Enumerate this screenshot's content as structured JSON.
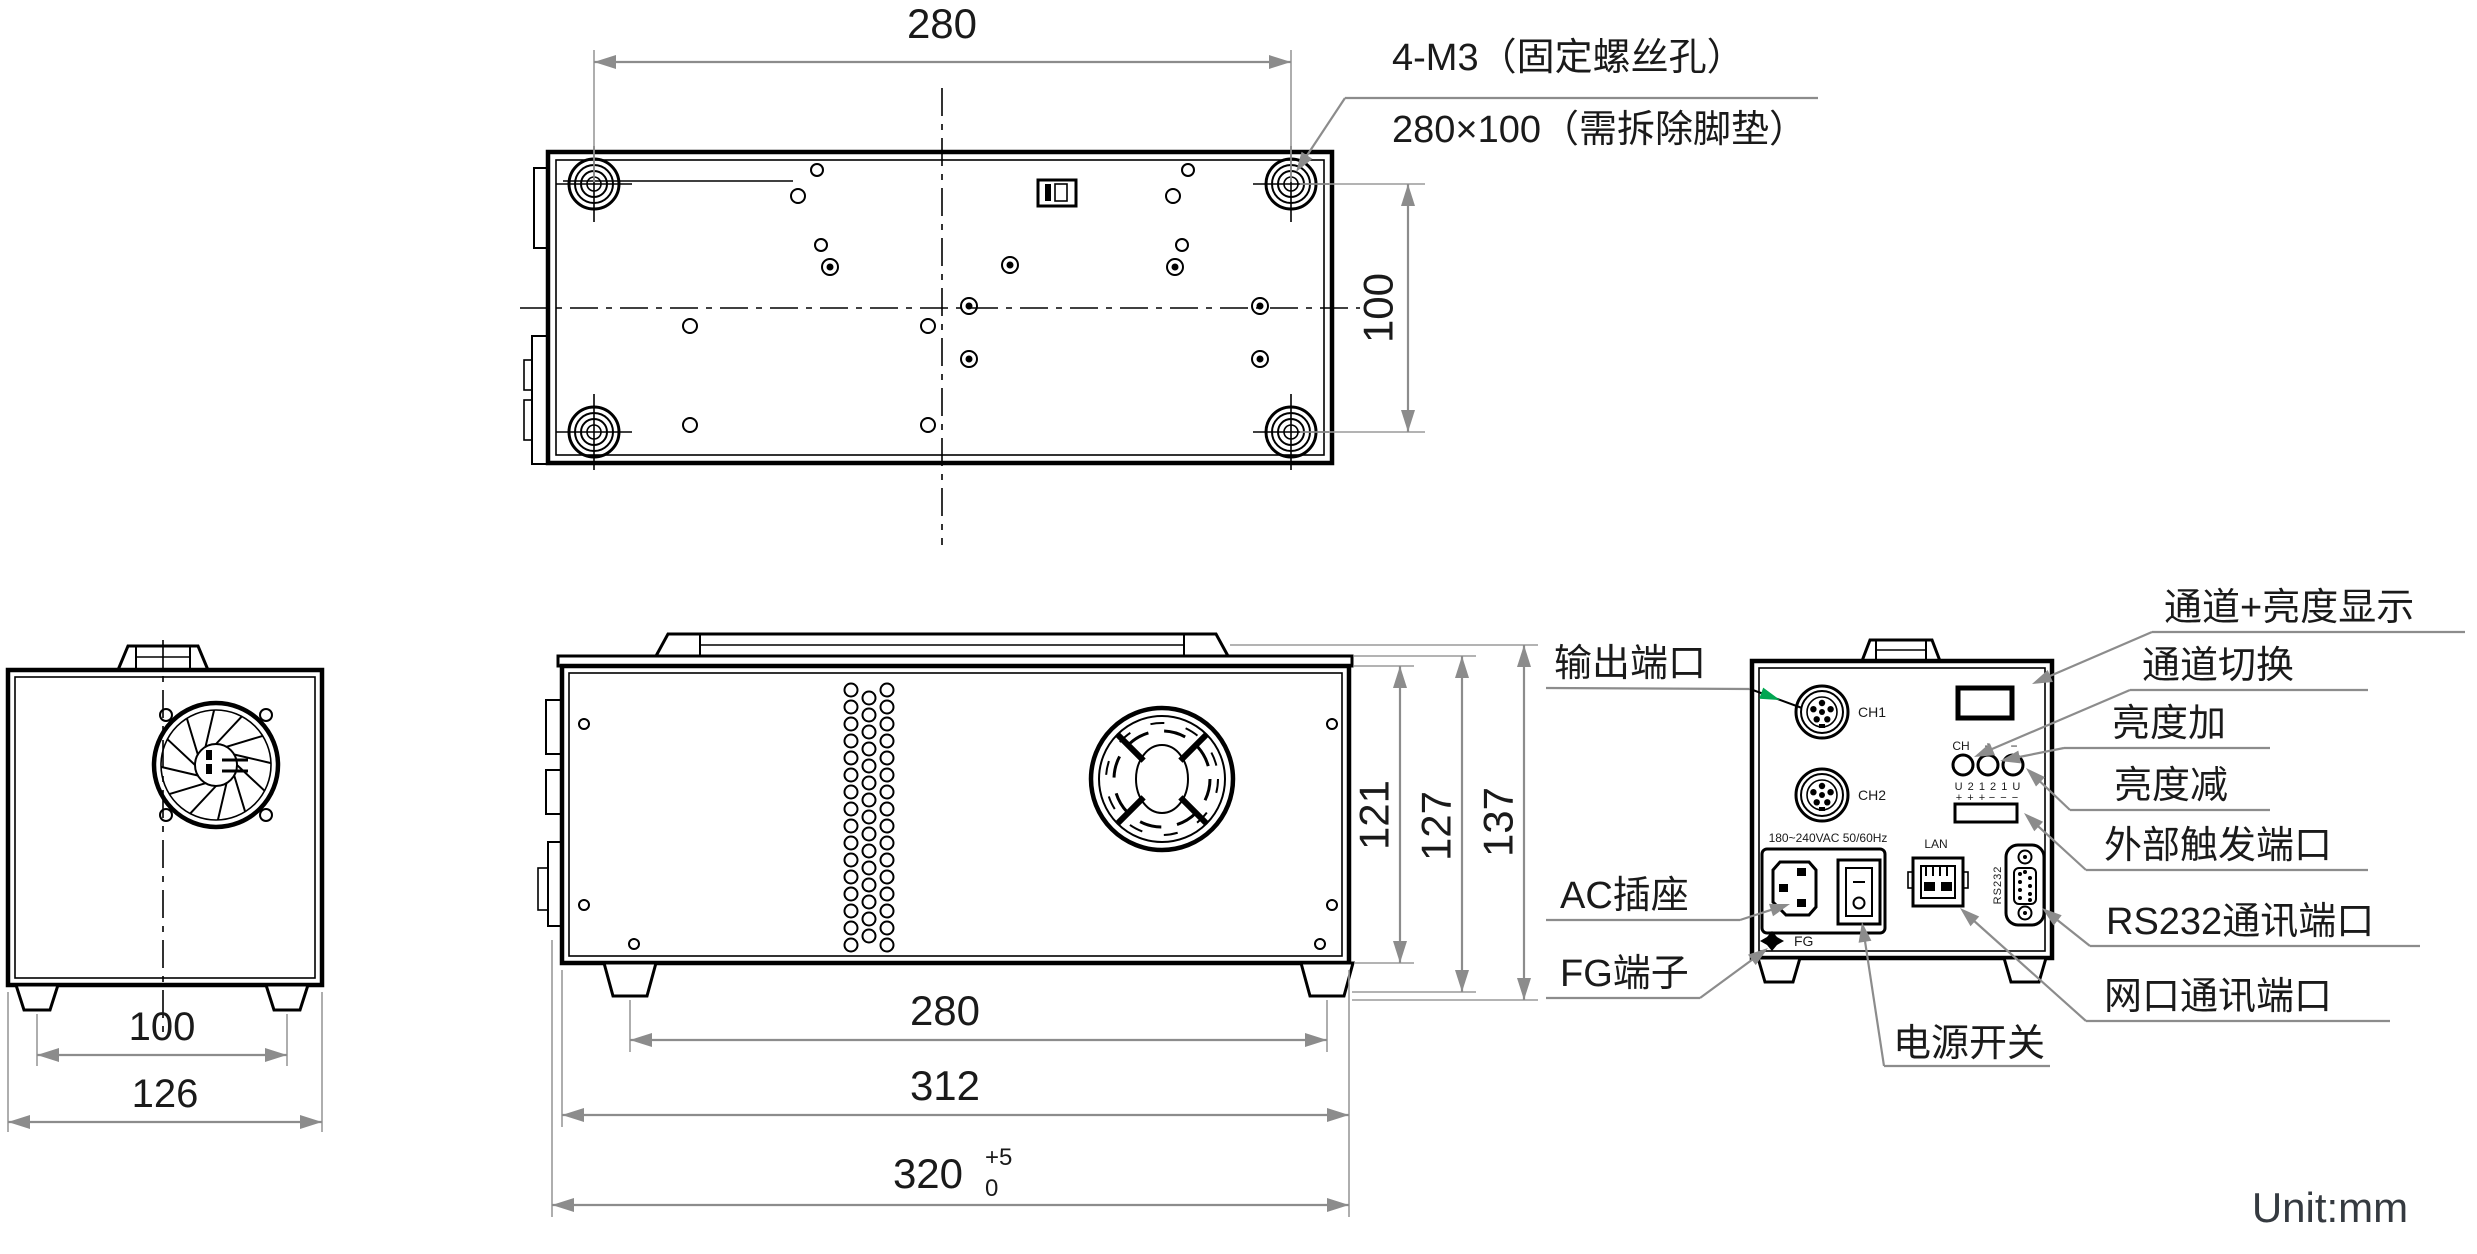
{
  "unit_note": "Unit:mm",
  "colors": {
    "line": "#000000",
    "dimension": "#8c8c8c",
    "text": "#1a1a1a",
    "arrow_accent": "#00a651"
  },
  "top_view": {
    "dim_width": "280",
    "dim_height": "100",
    "callout_line1": "4-M3（固定螺丝孔）",
    "callout_line2": "280×100（需拆除脚垫）"
  },
  "left_view": {
    "dim_feet": "100",
    "dim_overall": "126"
  },
  "front_view": {
    "dim_feet": "280",
    "dim_body": "312",
    "dim_overall": "320",
    "tol_plus": "+5",
    "tol_zero": "0",
    "dim_h_body": "121",
    "dim_h_mid": "127",
    "dim_h_overall": "137"
  },
  "rear_view": {
    "port_ch1": "CH1",
    "port_ch2": "CH2",
    "voltage": "180~240VAC 50/60Hz",
    "lan_label": "LAN",
    "rs232_label": "RS232",
    "fg_label": "FG",
    "btn_ch": "CH",
    "btn_plus": "+",
    "btn_minus": "−",
    "pin_row": "U 2 1 2 1 U",
    "pin_plus": "+ + +",
    "pin_minus": "− − −",
    "callouts_left": [
      "输出端口",
      "AC插座",
      "FG端子"
    ],
    "callout_power": "电源开关",
    "callouts_right": [
      "通道+亮度显示",
      "通道切换",
      "亮度加",
      "亮度减",
      "外部触发端口",
      "RS232通讯端口",
      "网口通讯端口"
    ]
  }
}
